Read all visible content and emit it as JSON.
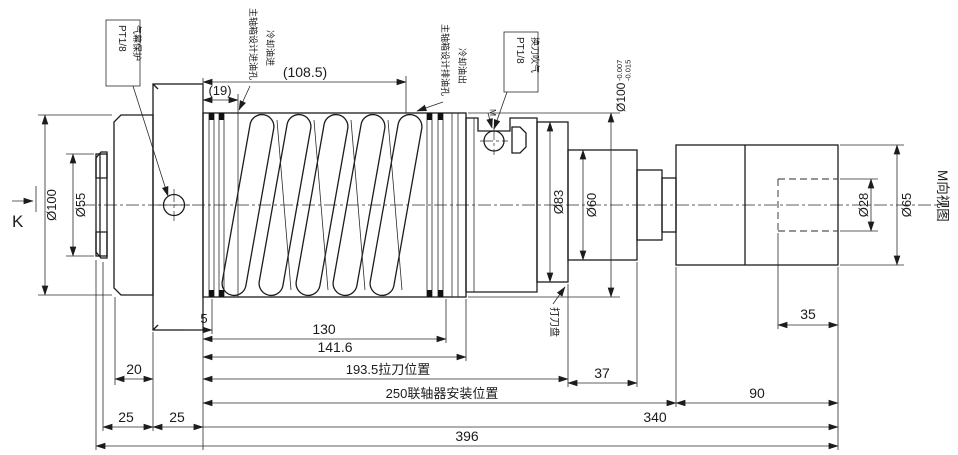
{
  "drawing": {
    "view_labels": {
      "k": "K",
      "m_view": "M向视图",
      "m_marker": "M"
    },
    "callouts": {
      "air_curtain": {
        "text": "气幕保护",
        "port": "PT1/8"
      },
      "inlet": {
        "main": "主轴箱设计进油孔",
        "sub": "冷却油进"
      },
      "outlet": {
        "main": "主轴箱设计排油孔",
        "sub": "冷却油出"
      },
      "tool_blow": {
        "text": "换刀吹气",
        "port": "PT1/8"
      },
      "knockout_disc": "打刀盘"
    },
    "diameter_dims": {
      "d100_left": "Ø100",
      "d55": "Ø55",
      "d83": "Ø83",
      "d60": "Ø60",
      "d28": "Ø28",
      "d65": "Ø65",
      "d100_tol": {
        "base": "Ø100",
        "upper": "-0.007",
        "lower": "-0.015"
      }
    },
    "length_dims": {
      "l19": "(19)",
      "l108_5": "(108.5)",
      "l5": "5",
      "l130": "130",
      "l141_6": "141.6",
      "l193_5": "193.5拉刀位置",
      "l250": "250联轴器安装位置",
      "l340": "340",
      "l396": "396",
      "l20": "20",
      "l25_a": "25",
      "l25_b": "25",
      "l37": "37",
      "l90": "90",
      "l35": "35"
    }
  }
}
